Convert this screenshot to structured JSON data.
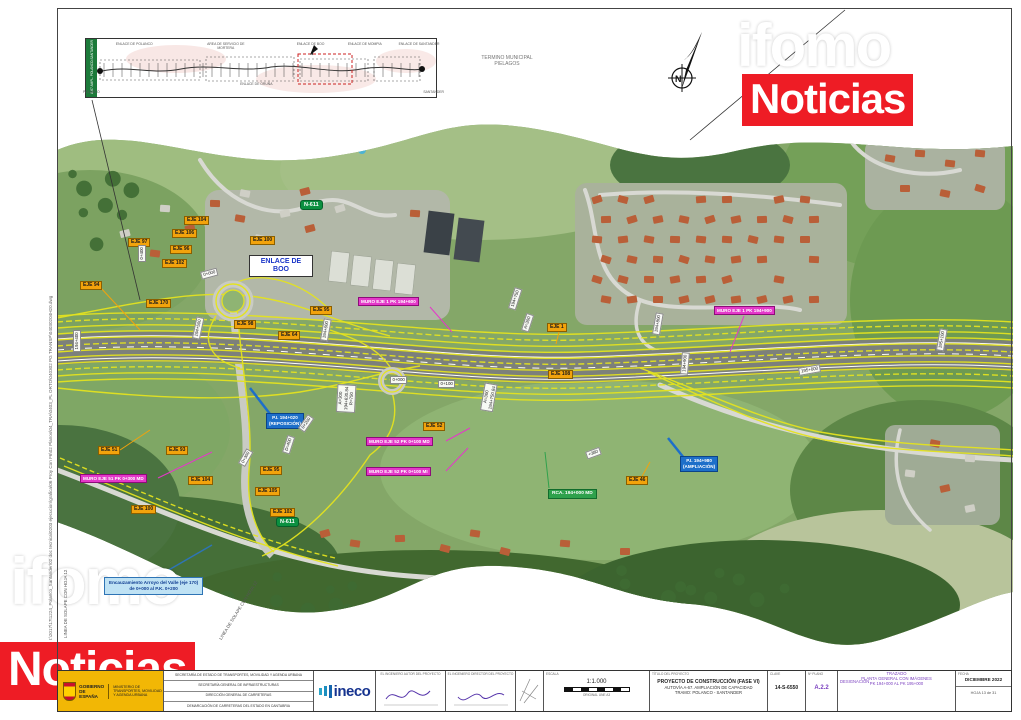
{
  "watermark": {
    "word1": "ifomo",
    "word2": "Noticias",
    "red": "#ee1c25"
  },
  "misc": {
    "municipal_line1": "TERMINO MUNICIPAL",
    "municipal_line2": "PIELAGOS",
    "north_letter": "N",
    "filepath": "I:\\2017\\17t1224_Polanco_Santander\\02 doc tecnica\\0203 ejecucion\\grafica\\06 Proy Con F6\\02 Planos\\04_TRA\\0403_PL ORTO\\040302 PG TRANSP\\04030204H20.dwg",
    "solape_left": "LINEA DE SOLAPE CON HOJA 12",
    "solape_diag": "LINEA DE SOLAPE CON HOJA 12"
  },
  "inset": {
    "tab": "A-67 AMPL. POLANCO-SANTANDER",
    "labels_top": [
      {
        "t": "ENLACE DE POLANCO",
        "p": 11
      },
      {
        "t": "AREA DE SERVICIO DE MORTERA",
        "p": 38
      },
      {
        "t": "ENLACE DE BOO",
        "p": 63
      },
      {
        "t": "ENLACE DE MOMPIA",
        "p": 79
      },
      {
        "t": "ENLACE DE SANTANDER",
        "p": 95
      }
    ],
    "labels_bottom": [
      {
        "t": "ENLACE DE ORUÑA",
        "p": 47
      }
    ],
    "start": "POLANCO",
    "end": "SANTANDER"
  },
  "map_labels": {
    "enlace": {
      "line1": "ENLACE DE",
      "line2": "BOO"
    },
    "eje": [
      {
        "t": "EJE 104",
        "x": 184,
        "y": 216
      },
      {
        "t": "EJE 106",
        "x": 172,
        "y": 229
      },
      {
        "t": "EJE 97",
        "x": 128,
        "y": 238
      },
      {
        "t": "EJE 96",
        "x": 170,
        "y": 245
      },
      {
        "t": "EJE 102",
        "x": 162,
        "y": 259
      },
      {
        "t": "EJE 94",
        "x": 80,
        "y": 281
      },
      {
        "t": "EJE 170",
        "x": 146,
        "y": 299
      },
      {
        "t": "EJE 100",
        "x": 250,
        "y": 236
      },
      {
        "t": "EJE 95",
        "x": 310,
        "y": 306
      },
      {
        "t": "EJE 98",
        "x": 234,
        "y": 320
      },
      {
        "t": "EJE 64",
        "x": 278,
        "y": 331
      },
      {
        "t": "EJE 1",
        "x": 547,
        "y": 323
      },
      {
        "t": "EJE 52",
        "x": 423,
        "y": 422
      },
      {
        "t": "EJE 51",
        "x": 98,
        "y": 446
      },
      {
        "t": "EJE 93",
        "x": 166,
        "y": 446
      },
      {
        "t": "EJE 104",
        "x": 188,
        "y": 476
      },
      {
        "t": "EJE 95",
        "x": 260,
        "y": 466
      },
      {
        "t": "EJE 105",
        "x": 255,
        "y": 487
      },
      {
        "t": "EJE 100",
        "x": 131,
        "y": 505
      },
      {
        "t": "EJE 102",
        "x": 270,
        "y": 508
      },
      {
        "t": "EJE 46",
        "x": 626,
        "y": 476
      },
      {
        "t": "EJE 108",
        "x": 548,
        "y": 370
      }
    ],
    "muro": [
      {
        "t": "MURO EJE 1 PK 194+600",
        "x": 358,
        "y": 297
      },
      {
        "t": "MURO EJE 1 PK 194+900",
        "x": 714,
        "y": 306
      },
      {
        "t": "MURO EJE 52 PK 0+100 MD",
        "x": 366,
        "y": 437
      },
      {
        "t": "MURO EJE 52 PK 0+100 MI",
        "x": 366,
        "y": 467
      },
      {
        "t": "MURO EJE 51 PK 0+300 MD",
        "x": 80,
        "y": 474
      }
    ],
    "pi": [
      {
        "lines": [
          "P.I. 194+020",
          "(REPOSICIÓN)"
        ],
        "x": 266,
        "y": 413
      },
      {
        "lines": [
          "P.I. 194+980",
          "(AMPLIACIÓN)"
        ],
        "x": 680,
        "y": 456
      }
    ],
    "rca": {
      "t": "RCA. 194+000 MD",
      "x": 548,
      "y": 489
    },
    "shields": [
      {
        "t": "N-611",
        "x": 300,
        "y": 200
      },
      {
        "t": "N-611",
        "x": 276,
        "y": 517
      }
    ],
    "stations": [
      {
        "t": "194+400",
        "x": 73,
        "y": 352,
        "r": -90
      },
      {
        "t": "194+500",
        "x": 192,
        "y": 338,
        "r": -78
      },
      {
        "t": "194+600",
        "x": 320,
        "y": 340,
        "r": -80
      },
      {
        "t": "194+750",
        "x": 508,
        "y": 308,
        "r": -72
      },
      {
        "t": "A=300",
        "x": 521,
        "y": 330,
        "r": -72
      },
      {
        "t": "194+800",
        "x": 652,
        "y": 334,
        "r": -80
      },
      {
        "t": "194+900",
        "x": 680,
        "y": 374,
        "r": -85
      },
      {
        "t": "195+000",
        "x": 798,
        "y": 368,
        "r": -10
      },
      {
        "t": "195+100",
        "x": 936,
        "y": 350,
        "r": -80
      },
      {
        "t": "0+000",
        "x": 200,
        "y": 272,
        "r": -15
      },
      {
        "t": "0+400",
        "x": 138,
        "y": 262,
        "r": -90
      },
      {
        "t": "0+000",
        "x": 390,
        "y": 376,
        "r": 0
      },
      {
        "t": "0+100",
        "x": 438,
        "y": 380,
        "r": 0
      },
      {
        "t": "0+200",
        "x": 298,
        "y": 428,
        "r": -55
      },
      {
        "t": "D=400",
        "x": 282,
        "y": 452,
        "r": -72
      },
      {
        "t": "0+300",
        "x": 238,
        "y": 463,
        "r": -60
      },
      {
        "t": "+380",
        "x": 585,
        "y": 452,
        "r": -20
      }
    ],
    "curves": [
      {
        "lines": [
          "A=300",
          "194+630.84",
          "R=750"
        ],
        "x": 336,
        "y": 412,
        "r": -87
      },
      {
        "lines": [
          "A=300",
          "194+750.84"
        ],
        "x": 480,
        "y": 410,
        "r": -80
      }
    ],
    "encauz": {
      "lines": [
        "Encauzamiento Arroyo del Valle (eje 170)",
        "de 0+000 al P.K. 0+200"
      ],
      "x": 104,
      "y": 577
    }
  },
  "titleblock": {
    "gov_name_1": "GOBIERNO",
    "gov_name_2": "DE ESPAÑA",
    "gov_ministry": "MINISTERIO DE TRANSPORTES, MOVILIDAD Y AGENDA URBANA",
    "org_lines": [
      "SECRETARÍA DE ESTADO DE TRANSPORTES, MOVILIDAD Y AGENDA URBANA",
      "SECRETARÍA GENERAL DE INFRAESTRUCTURAS",
      "DIRECCIÓN GENERAL DE CARRETERAS",
      "DEMARCACIÓN DE CARRETERAS DEL ESTADO EN CANTABRIA"
    ],
    "ineco": "ineco",
    "sig1_header": "EL INGENIERO AUTOR DEL PROYECTO",
    "sig2_header": "EL INGENIERO DIRECTOR DEL PROYECTO",
    "escala_header": "ESCALA",
    "escala_value": "1:1.000",
    "escala_note": "ORIGINAL UNE A3",
    "titulo_header": "TÍTULO DEL PROYECTO",
    "titulo_lines": [
      "PROYECTO DE CONSTRUCCIÓN (FASE VI)",
      "AUTOVÍA A-67. AMPLIACIÓN DE CAPACIDAD",
      "TRAMO: POLANCO - SANTANDER"
    ],
    "clave_header": "CLAVE",
    "clave": "14-S-6550",
    "plano_header": "Nº PLANO",
    "plano": "A.2.2",
    "desig_header": "DESIGNACIÓN",
    "desig_lines": [
      "TRAZADO",
      "PLANTA GENERAL CON IMÁGENES",
      "PK 194+000 AL PK 195+000"
    ],
    "fecha_header": "FECHA",
    "fecha": "DICIEMBRE 2022",
    "hoja": "HOJA 13 de 31"
  }
}
